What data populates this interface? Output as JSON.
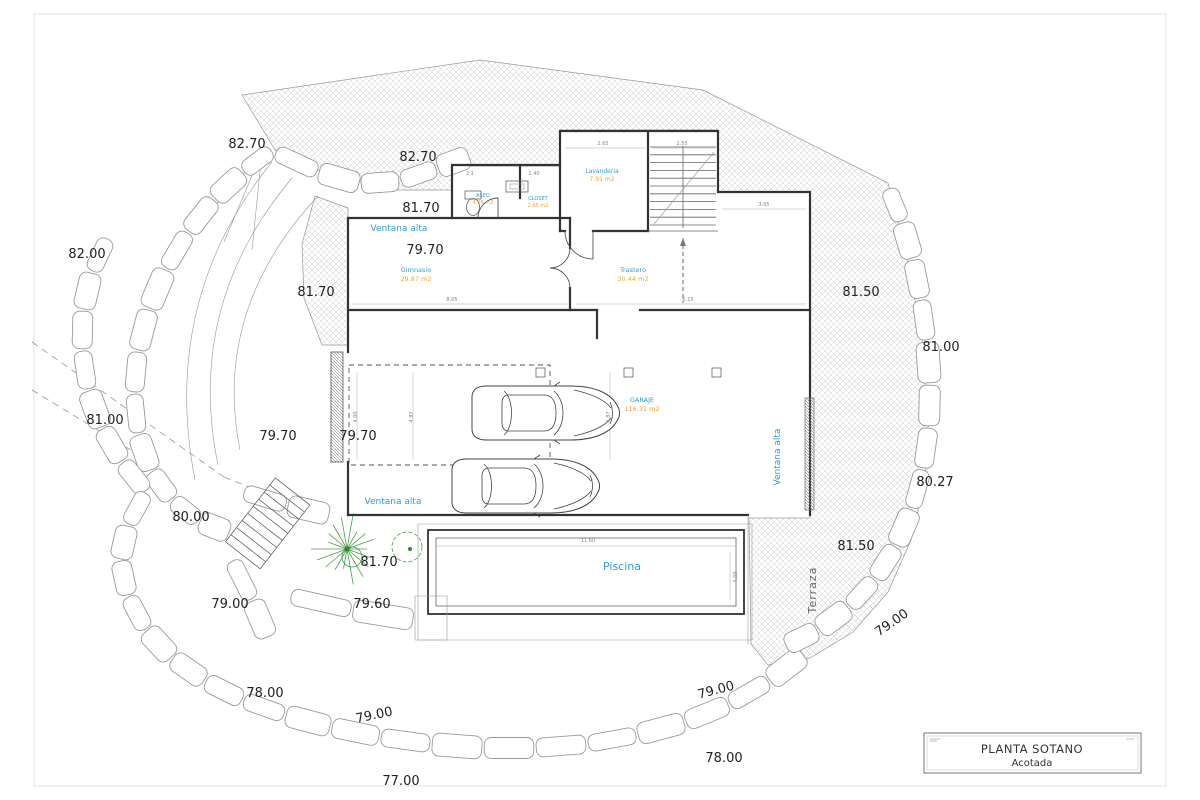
{
  "drawing": {
    "title_block": {
      "title": "PLANTA SOTANO",
      "subtitle": "Acotada"
    },
    "rooms": [
      {
        "name": "ASEO",
        "area": "4.26 m2"
      },
      {
        "name": "CLOSET",
        "area": "2.65 m2"
      },
      {
        "name": "Lavanderia",
        "area": "7.91 m2"
      },
      {
        "name": "Gimnasio",
        "area": "29.87 m2"
      },
      {
        "name": "Trastero",
        "area": "30.44 m2"
      },
      {
        "name": "GARAJE",
        "area": "116.31 m2"
      }
    ],
    "annotations": {
      "ventana_alta": "Ventana alta",
      "piscina": "Piscina",
      "terraza": "Terraza"
    },
    "elevations": [
      "82.70",
      "82.70",
      "81.70",
      "79.70",
      "81.70",
      "82.00",
      "81.00",
      "79.70",
      "79.70",
      "80.00",
      "81.70",
      "79.60",
      "79.00",
      "78.00",
      "79.00",
      "77.00",
      "78.00",
      "79.00",
      "79.00",
      "81.50",
      "80.27",
      "81.00",
      "81.50"
    ],
    "dimensions": [
      "2.1",
      "1.40",
      "2.65",
      "2.55",
      "3.65",
      "8.05",
      "6.15",
      "11.60",
      "4.00",
      "4.00",
      "4.87",
      "4.87"
    ],
    "colors": {
      "room_label": "#2f9fd0",
      "area_label": "#efa63c",
      "elevation_text": "#222222",
      "wall": "#333333",
      "stone": "#9a9a9a",
      "hatch": "#cccccc",
      "plant_green": "#2e8b2e"
    }
  }
}
